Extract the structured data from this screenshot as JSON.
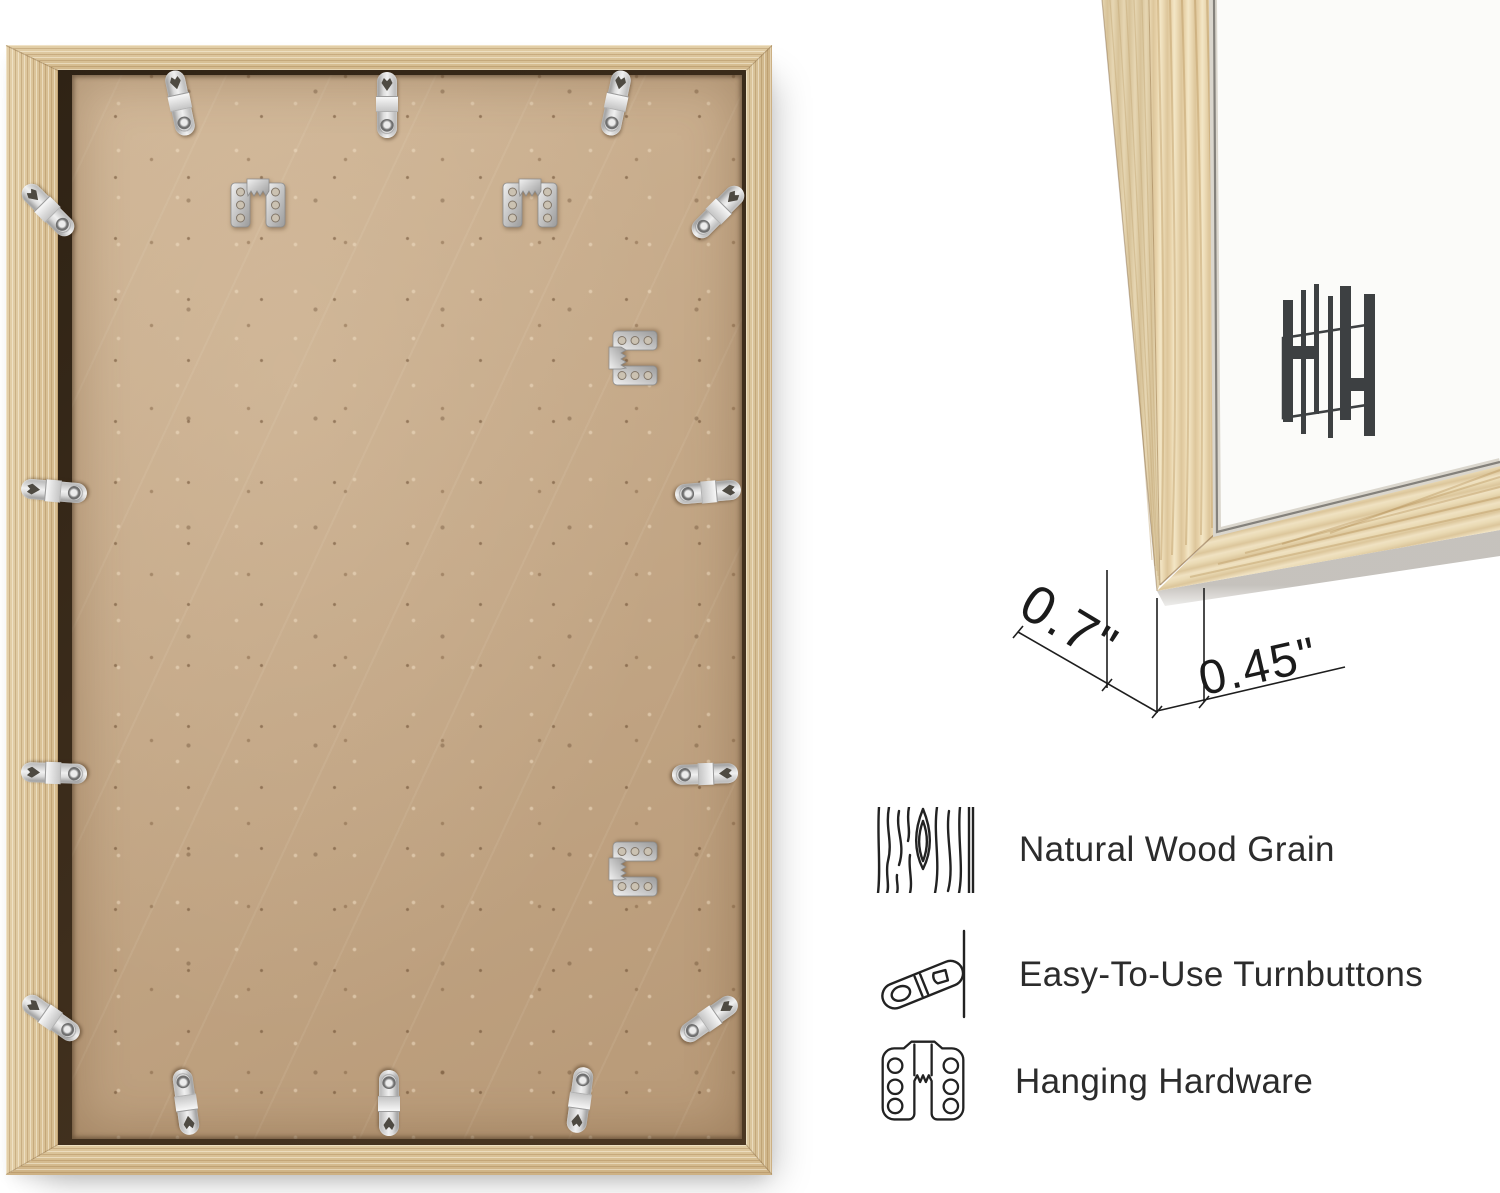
{
  "dimensions": {
    "depth_label": "0.7\"",
    "face_label": "0.45\""
  },
  "features": [
    {
      "icon": "wood-grain-icon",
      "label": "Natural Wood Grain"
    },
    {
      "icon": "turnbutton-icon",
      "label": "Easy-To-Use Turnbuttons"
    },
    {
      "icon": "hanging-hardware-icon",
      "label": "Hanging Hardware"
    }
  ],
  "logo": {
    "name": "HH monogram",
    "color": "#3d4042"
  },
  "back_view": {
    "turnbutton_count": 14,
    "sawtooth_hanger_count": 4
  },
  "colors": {
    "wood": "#d9c096",
    "wood_light": "#ecdbb6",
    "board": "#c6a987",
    "metal": "#d6d6d6",
    "mat": "#fbfbf9",
    "annotation": "#1b1b1b",
    "text": "#2c2c2c"
  }
}
